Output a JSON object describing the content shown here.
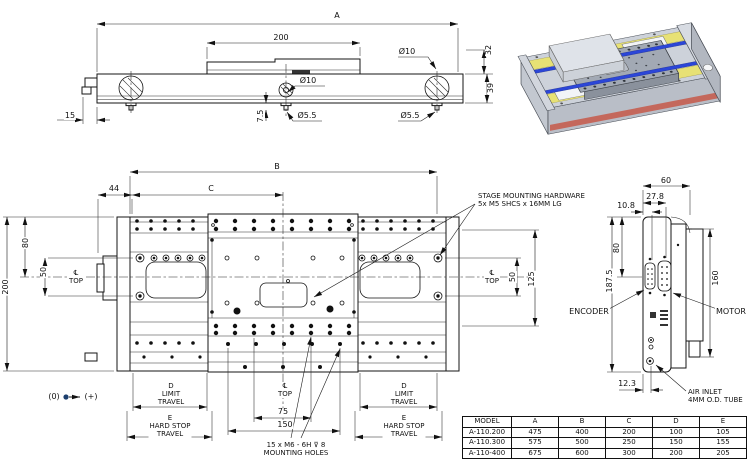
{
  "side_view": {
    "a": "A",
    "len_200": "200",
    "dia_10_top": "Ø10",
    "h_32": "32",
    "h_39": "39",
    "dia_10_mid": "Ø10",
    "off_15": "15",
    "dep_7_5": "7.5",
    "dia_5_5_mid": "Ø5.5",
    "dia_5_5_right": "Ø5.5"
  },
  "top_view": {
    "b": "B",
    "c": "C",
    "off_44": "44",
    "w_200": "200",
    "h_80": "80",
    "sp_50_left": "50",
    "sp_50_right": "50",
    "w_125": "125",
    "cl_top": "℄\nTOP",
    "d_travel": "D\nLIMIT\nTRAVEL",
    "e_travel": "E\nHARD STOP\nTRAVEL",
    "sp_75": "75",
    "sp_150": "150",
    "mount_note": "15 x  M6 - 6H ⊽ 8\nMOUNTING HOLES",
    "stage_note": "STAGE MOUNTING HARDWARE\n5x M5 SHCS x 16MM LG",
    "origin_zero": "(0)",
    "origin_plus": "(+)"
  },
  "end_view": {
    "w_60": "60",
    "off_27_8": "27.8",
    "off_10_8": "10.8",
    "h_80": "80",
    "h_187_5": "187.5",
    "h_160": "160",
    "off_12_3": "12.3",
    "encoder": "ENCODER",
    "motor": "MOTOR",
    "air_note": "AIR INLET\n4MM O.D. TUBE"
  },
  "table": {
    "headers": [
      "MODEL",
      "A",
      "B",
      "C",
      "D",
      "E"
    ],
    "rows": [
      [
        "A-110.200",
        "475",
        "400",
        "200",
        "100",
        "105"
      ],
      [
        "A-110.300",
        "575",
        "500",
        "250",
        "150",
        "155"
      ],
      [
        "A-110-400",
        "675",
        "600",
        "300",
        "200",
        "205"
      ]
    ]
  },
  "colors": {
    "rail_blue": "#2b46d8",
    "magnet_yellow": "#e7e175",
    "front_red": "#c4685c",
    "body_gray": "#cdd2da",
    "platform_gray": "#a2a9b4",
    "origin_dot": "#1c3f6e"
  }
}
